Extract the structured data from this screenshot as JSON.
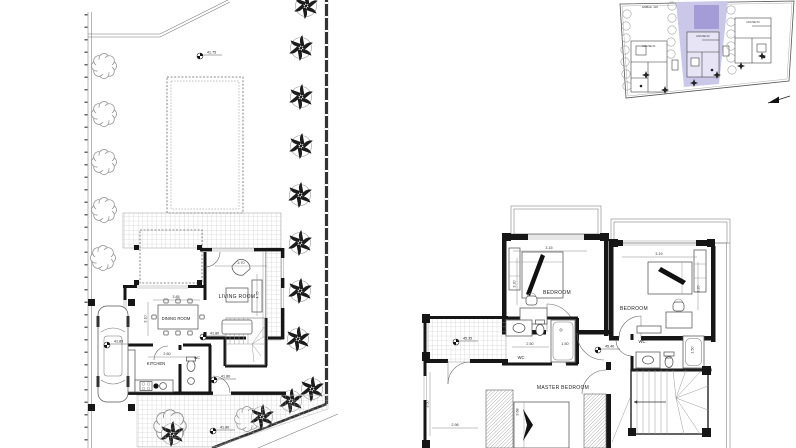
{
  "meta": {
    "background": "#ffffff",
    "line_color": "#1a1a1a",
    "highlight_color": "#cbc7e8",
    "pool_color": "#a49cd6"
  },
  "ground_floor": {
    "living_room": "LIVING ROOM",
    "dining_room": "DINING ROOM",
    "kitchen": "KITCHEN",
    "wc": "WC",
    "dims": {
      "living_w": "3.70",
      "living_d": "4.75",
      "dining_w": "3.85",
      "dining_d": "3.10",
      "kitchen_w": "2.60"
    },
    "levels": {
      "garden_top": "41.75",
      "driveway": "41.85",
      "terrace": "41.80",
      "hall": "41.80",
      "garden_path": "41.80"
    }
  },
  "first_floor": {
    "bedroom_left": "BEDROOM",
    "bedroom_right": "BEDROOM",
    "master_bedroom": "MASTER BEDROOM",
    "wc_left": "WC",
    "wc_right": "WC",
    "dims": {
      "bedroom_left_w": "3.15",
      "bedroom_left_d": "3.20",
      "bedroom_right_w": "3.19",
      "bedroom_right_d": "3.20",
      "bath_w": "2.50",
      "shower": "1.50",
      "tub": "1.50",
      "wc_right_w": "2.00",
      "master_d": "3.50",
      "master_w": "2.98",
      "master_bed": "3.68"
    },
    "levels": {
      "landing": "45.35",
      "hall": "45.40"
    }
  },
  "key_plan": {
    "house_left": "HOUSE 01",
    "house_mid": "HOUSE 02",
    "house_right": "HOUSE 03",
    "area_label": "ΕΜΒΑΔ. 418"
  }
}
